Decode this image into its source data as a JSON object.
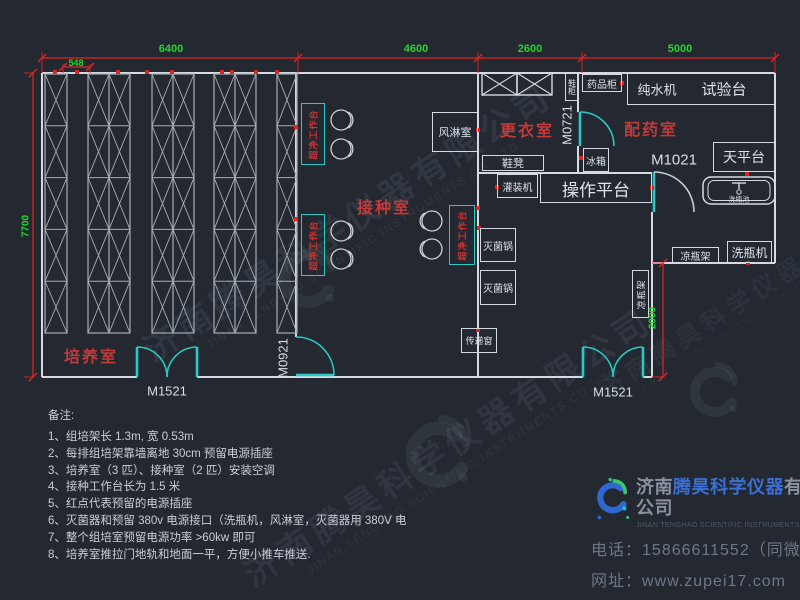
{
  "colors": {
    "background": "#232831",
    "wall": "#d6dae0",
    "rack": "#a7adb5",
    "cyan": "#2cc8c4",
    "dim_red": "#e02424",
    "dim_green": "#25d52c",
    "room_red": "#c23a3a",
    "outlet_red": "#e12222"
  },
  "dim_labels": [
    {
      "text": "6400",
      "x": 171,
      "y": 49,
      "fs": 11,
      "rot": 0
    },
    {
      "text": "4600",
      "x": 416,
      "y": 49,
      "fs": 11,
      "rot": 0
    },
    {
      "text": "2600",
      "x": 530,
      "y": 49,
      "fs": 11,
      "rot": 0
    },
    {
      "text": "5000",
      "x": 680,
      "y": 49,
      "fs": 11,
      "rot": 0
    },
    {
      "text": "548",
      "x": 76,
      "y": 63,
      "fs": 9,
      "rot": 0
    },
    {
      "text": "7700",
      "x": 26,
      "y": 226,
      "fs": 10,
      "rot": -90
    },
    {
      "text": "2000",
      "x": 653,
      "y": 318,
      "fs": 10,
      "rot": -90
    }
  ],
  "room_labels": [
    {
      "text": "培养室",
      "x": 91,
      "y": 355,
      "fs": 16
    },
    {
      "text": "接种室",
      "x": 384,
      "y": 206,
      "fs": 16
    },
    {
      "text": "更衣室",
      "x": 527,
      "y": 129,
      "fs": 16
    },
    {
      "text": "配药室",
      "x": 651,
      "y": 128,
      "fs": 16
    }
  ],
  "door_labels": [
    {
      "text": "M1521",
      "x": 167,
      "y": 391,
      "fs": 13,
      "rot": 0
    },
    {
      "text": "M1521",
      "x": 613,
      "y": 392,
      "fs": 13,
      "rot": 0
    },
    {
      "text": "M0921",
      "x": 283,
      "y": 358,
      "fs": 13,
      "rot": -90
    },
    {
      "text": "M0721",
      "x": 567,
      "y": 125,
      "fs": 13,
      "rot": -90
    },
    {
      "text": "M1021",
      "x": 674,
      "y": 160,
      "fs": 15,
      "rot": 0
    }
  ],
  "free_labels": [
    {
      "text": "纯水机",
      "x": 657,
      "y": 89,
      "fs": 13
    },
    {
      "text": "试验台",
      "x": 724,
      "y": 89,
      "fs": 15
    }
  ],
  "equipment": [
    {
      "label": "风淋室",
      "x": 432,
      "y": 112,
      "w": 46,
      "h": 40,
      "fs": 11
    },
    {
      "label": "药品柜",
      "x": 582,
      "y": 74,
      "w": 40,
      "h": 18,
      "fs": 10
    },
    {
      "label": "",
      "x": 627,
      "y": 73,
      "w": 148,
      "h": 32,
      "fs": 12
    },
    {
      "label": "冰箱",
      "x": 583,
      "y": 148,
      "w": 26,
      "h": 24,
      "fs": 10
    },
    {
      "label": "天平台",
      "x": 713,
      "y": 142,
      "w": 62,
      "h": 30,
      "fs": 14
    },
    {
      "label": "鞋凳",
      "x": 482,
      "y": 155,
      "w": 62,
      "h": 16,
      "fs": 11
    },
    {
      "label": "灌装机",
      "x": 497,
      "y": 174,
      "w": 41,
      "h": 24,
      "fs": 10
    },
    {
      "label": "操作平台",
      "x": 540,
      "y": 173,
      "w": 112,
      "h": 30,
      "fs": 17
    },
    {
      "label": "灭菌锅",
      "x": 480,
      "y": 228,
      "w": 36,
      "h": 34,
      "fs": 10
    },
    {
      "label": "灭菌锅",
      "x": 480,
      "y": 270,
      "w": 36,
      "h": 35,
      "fs": 10
    },
    {
      "label": "传递窗",
      "x": 461,
      "y": 328,
      "w": 36,
      "h": 25,
      "fs": 9
    },
    {
      "label": "凉瓶架",
      "x": 632,
      "y": 270,
      "w": 17,
      "h": 48,
      "fs": 9,
      "rot": true
    },
    {
      "label": "凉瓶架",
      "x": 672,
      "y": 247,
      "w": 47,
      "h": 16,
      "fs": 10
    },
    {
      "label": "洗瓶机",
      "x": 727,
      "y": 241,
      "w": 45,
      "h": 22,
      "fs": 12
    },
    {
      "label": "鞋柜",
      "x": 565,
      "y": 73,
      "w": 13,
      "h": 28,
      "fs": 8,
      "upright": true
    }
  ],
  "benches": {
    "label": "超净工作台",
    "boxes": [
      {
        "x": 301,
        "y": 103,
        "w": 24,
        "h": 62
      },
      {
        "x": 301,
        "y": 214,
        "w": 24,
        "h": 62
      },
      {
        "x": 449,
        "y": 205,
        "w": 26,
        "h": 60
      }
    ]
  },
  "stools": [
    {
      "cx": 341,
      "cy": 120,
      "side": 1
    },
    {
      "cx": 341,
      "cy": 149,
      "side": 1
    },
    {
      "cx": 341,
      "cy": 231,
      "side": 1
    },
    {
      "cx": 341,
      "cy": 259,
      "side": 1
    },
    {
      "cx": 432,
      "cy": 221,
      "side": -1
    },
    {
      "cx": 432,
      "cy": 249,
      "side": -1
    }
  ],
  "outlets": [
    [
      55,
      72
    ],
    [
      77,
      72
    ],
    [
      118,
      72
    ],
    [
      147,
      72
    ],
    [
      172,
      72
    ],
    [
      222,
      72
    ],
    [
      232,
      72
    ],
    [
      256,
      72
    ],
    [
      277,
      72
    ],
    [
      296,
      127
    ],
    [
      296,
      219
    ],
    [
      478,
      130
    ],
    [
      478,
      208
    ],
    [
      479,
      228
    ],
    [
      478,
      330
    ],
    [
      497,
      187
    ],
    [
      581,
      158
    ],
    [
      652,
      188
    ],
    [
      747,
      174
    ],
    [
      748,
      263
    ],
    [
      622,
      83
    ]
  ],
  "walls": [
    [
      42,
      73,
      775,
      73
    ],
    [
      42,
      73,
      42,
      377
    ],
    [
      42,
      377,
      137,
      377
    ],
    [
      197,
      377,
      583,
      377
    ],
    [
      643,
      377,
      652,
      377
    ],
    [
      775,
      73,
      775,
      263
    ],
    [
      652,
      263,
      775,
      263
    ],
    [
      652,
      263,
      652,
      377
    ],
    [
      296,
      73,
      296,
      337
    ],
    [
      478,
      73,
      478,
      377
    ],
    [
      578,
      73,
      578,
      112
    ],
    [
      578,
      146,
      578,
      173
    ],
    [
      478,
      173,
      652,
      173
    ],
    [
      652,
      212,
      652,
      263
    ]
  ],
  "racks": [
    {
      "x": 45,
      "y": 74,
      "w": 22,
      "h": 259,
      "cols": 1,
      "rows": 5
    },
    {
      "x": 88,
      "y": 74,
      "w": 42,
      "h": 259,
      "cols": 2,
      "rows": 5
    },
    {
      "x": 152,
      "y": 74,
      "w": 42,
      "h": 259,
      "cols": 2,
      "rows": 5
    },
    {
      "x": 214,
      "y": 74,
      "w": 42,
      "h": 259,
      "cols": 2,
      "rows": 5
    },
    {
      "x": 277,
      "y": 74,
      "w": 20,
      "h": 259,
      "cols": 1,
      "rows": 5
    }
  ],
  "lockers": [
    [
      482,
      73,
      35,
      22
    ],
    [
      517,
      73,
      35,
      22
    ]
  ],
  "dim_lines": [
    [
      42,
      58,
      775,
      58
    ],
    [
      63,
      67,
      90,
      67
    ],
    [
      33,
      73,
      33,
      377
    ],
    [
      663,
      263,
      663,
      377
    ]
  ],
  "ext_lines": [
    [
      42,
      73,
      42,
      52
    ],
    [
      298,
      73,
      298,
      52
    ],
    [
      478,
      73,
      478,
      52
    ],
    [
      582,
      73,
      582,
      52
    ],
    [
      775,
      73,
      775,
      52
    ],
    [
      33,
      73,
      24,
      73
    ],
    [
      33,
      377,
      24,
      377
    ],
    [
      663,
      263,
      652,
      263
    ],
    [
      663,
      377,
      652,
      377
    ],
    [
      63,
      73,
      63,
      64
    ],
    [
      90,
      73,
      90,
      64
    ]
  ],
  "dim_ticks": [
    [
      42,
      58
    ],
    [
      298,
      58
    ],
    [
      478,
      58
    ],
    [
      582,
      58
    ],
    [
      775,
      58
    ],
    [
      63,
      67
    ],
    [
      90,
      67
    ],
    [
      33,
      73
    ],
    [
      33,
      377
    ],
    [
      663,
      263
    ],
    [
      663,
      377
    ]
  ],
  "cyan_lines": [
    [
      137,
      347,
      137,
      377
    ],
    [
      197,
      347,
      197,
      377
    ],
    [
      583,
      347,
      583,
      377
    ],
    [
      643,
      347,
      643,
      377
    ],
    [
      296,
      375,
      334,
      375
    ],
    [
      580,
      112,
      580,
      146
    ],
    [
      654,
      172,
      654,
      212
    ]
  ],
  "door_arcs": [
    {
      "d": "M137,347 A30,30 0 0 1 167,377",
      "c": "#2cc8c4"
    },
    {
      "d": "M197,347 A30,30 0 0 0 167,377",
      "c": "#2cc8c4"
    },
    {
      "d": "M583,347 A30,30 0 0 1 613,377",
      "c": "#2cc8c4"
    },
    {
      "d": "M643,347 A30,30 0 0 0 613,377",
      "c": "#2cc8c4"
    },
    {
      "d": "M296,337 A38,38 0 0 1 334,375",
      "c": "#2cc8c4"
    },
    {
      "d": "M580,112 A34,34 0 0 1 614,146",
      "c": "#2cc8c4"
    },
    {
      "d": "M654,172 A40,40 0 0 1 694,212",
      "c": "#c9ced6"
    }
  ],
  "sink": {
    "x": 703,
    "y": 177,
    "w": 72,
    "h": 27,
    "label": "洗瓶池"
  },
  "notes": {
    "title": "备注:",
    "items": [
      "1、组培架长 1.3m, 宽 0.53m",
      "2、每排组培架靠墙离地 30cm 预留电源插座",
      "3、培养室（3 匹）、接种室（2 匹）安装空调",
      "4、接种工作台长为 1.5 米",
      "5、红点代表预留的电源插座",
      "6、灭菌器和预留 380v 电源接口（洗瓶机，风淋室，灭菌器用 380V 电",
      "7、整个组培室预留电源功率 >60kw 即可",
      "8、培养室推拉门地轨和地面一平，方便小推车推送."
    ]
  },
  "company": {
    "name_prefix": "济南",
    "name_mid": "腾昊科学仪器",
    "name_suffix": "有限公司",
    "english": "JINAN TENGHAO SCIENTIFIC INSTRUMENTS CO.,LTD.",
    "phone_label": "电话：",
    "phone": "15866611552（同微信）",
    "web_label": "网址：",
    "website": "www.zupei17.com"
  },
  "watermark": {
    "text": "济南腾昊科学仪器有限公司",
    "subtext": "JINAN TENGHAO SCIENTIFIC INSTRUMENTS CO.,LTD",
    "instances": [
      {
        "x": 350,
        "y": 225,
        "fs": 34,
        "op": 0.085
      },
      {
        "x": 450,
        "y": 450,
        "fs": 34,
        "op": 0.08
      },
      {
        "x": 755,
        "y": 295,
        "fs": 24,
        "op": 0.06
      }
    ],
    "swirls": [
      {
        "x": 305,
        "y": 285,
        "s": 85
      },
      {
        "x": 435,
        "y": 462,
        "s": 95
      },
      {
        "x": 712,
        "y": 398,
        "s": 72
      }
    ]
  }
}
